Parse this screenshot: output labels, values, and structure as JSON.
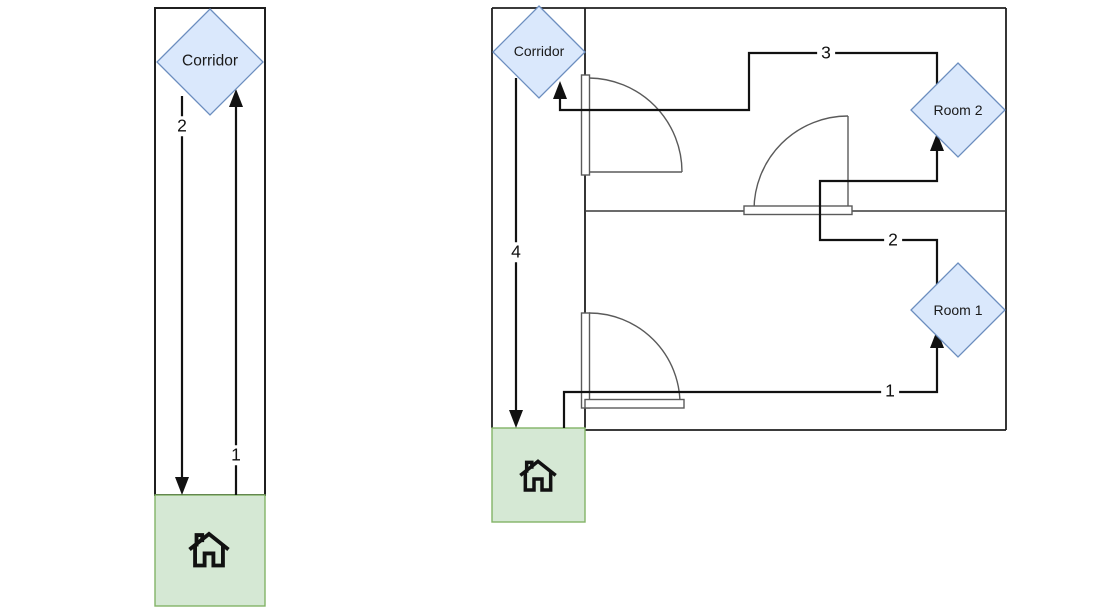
{
  "figure": {
    "type": "floorplan-route-diagram",
    "background": "#ffffff"
  },
  "colors": {
    "node_fill": "#dae8fc",
    "node_border": "#6c8ebf",
    "home_fill": "#d5e8d4",
    "home_border": "#82b366",
    "wall": "#1f1f1f",
    "door": "#5a5a5a",
    "route": "#111111"
  },
  "left_diagram": {
    "corridor_label": "Corridor",
    "home_icon": "house-icon",
    "routes": [
      {
        "label": "1",
        "from": "home",
        "to": "corridor",
        "direction": "up"
      },
      {
        "label": "2",
        "from": "corridor",
        "to": "home",
        "direction": "down"
      }
    ]
  },
  "right_diagram": {
    "corridor_label": "Corridor",
    "room1_label": "Room 1",
    "room2_label": "Room 2",
    "home_icon": "house-icon",
    "routes": [
      {
        "label": "1",
        "from": "home",
        "to": "room1"
      },
      {
        "label": "2",
        "from": "room1",
        "to": "room2"
      },
      {
        "label": "3",
        "from": "room2",
        "to": "corridor"
      },
      {
        "label": "4",
        "from": "corridor",
        "to": "home"
      }
    ]
  }
}
